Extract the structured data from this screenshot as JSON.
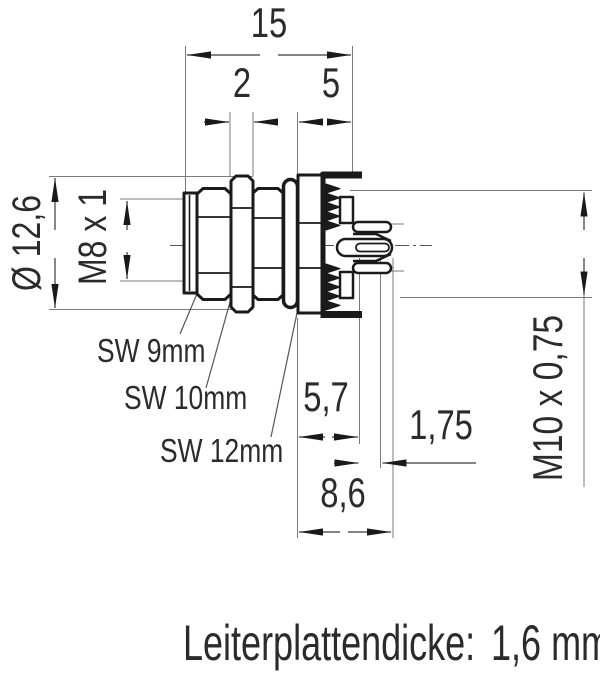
{
  "dims": {
    "total_length": "15",
    "nut_width": "2",
    "rear_section": "5",
    "flange_diameter": "Ø 12,6",
    "front_thread": "M8 x 1",
    "depth_to_board": "5,7",
    "pin_offset": "1,75",
    "pin_length": "8,6",
    "panel_thread": "M10 x 0,75"
  },
  "wrench_labels": {
    "sw9": "SW 9mm",
    "sw10": "SW 10mm",
    "sw12": "SW 12mm"
  },
  "note": {
    "label": "Leiterplattendicke:",
    "value": "1,6 mm"
  },
  "colors": {
    "outline": "#1a1a1a",
    "dimension_line": "#3a3a3a",
    "extension_line": "#7a7a7a",
    "text": "#2b2b2b",
    "background": "#ffffff"
  }
}
